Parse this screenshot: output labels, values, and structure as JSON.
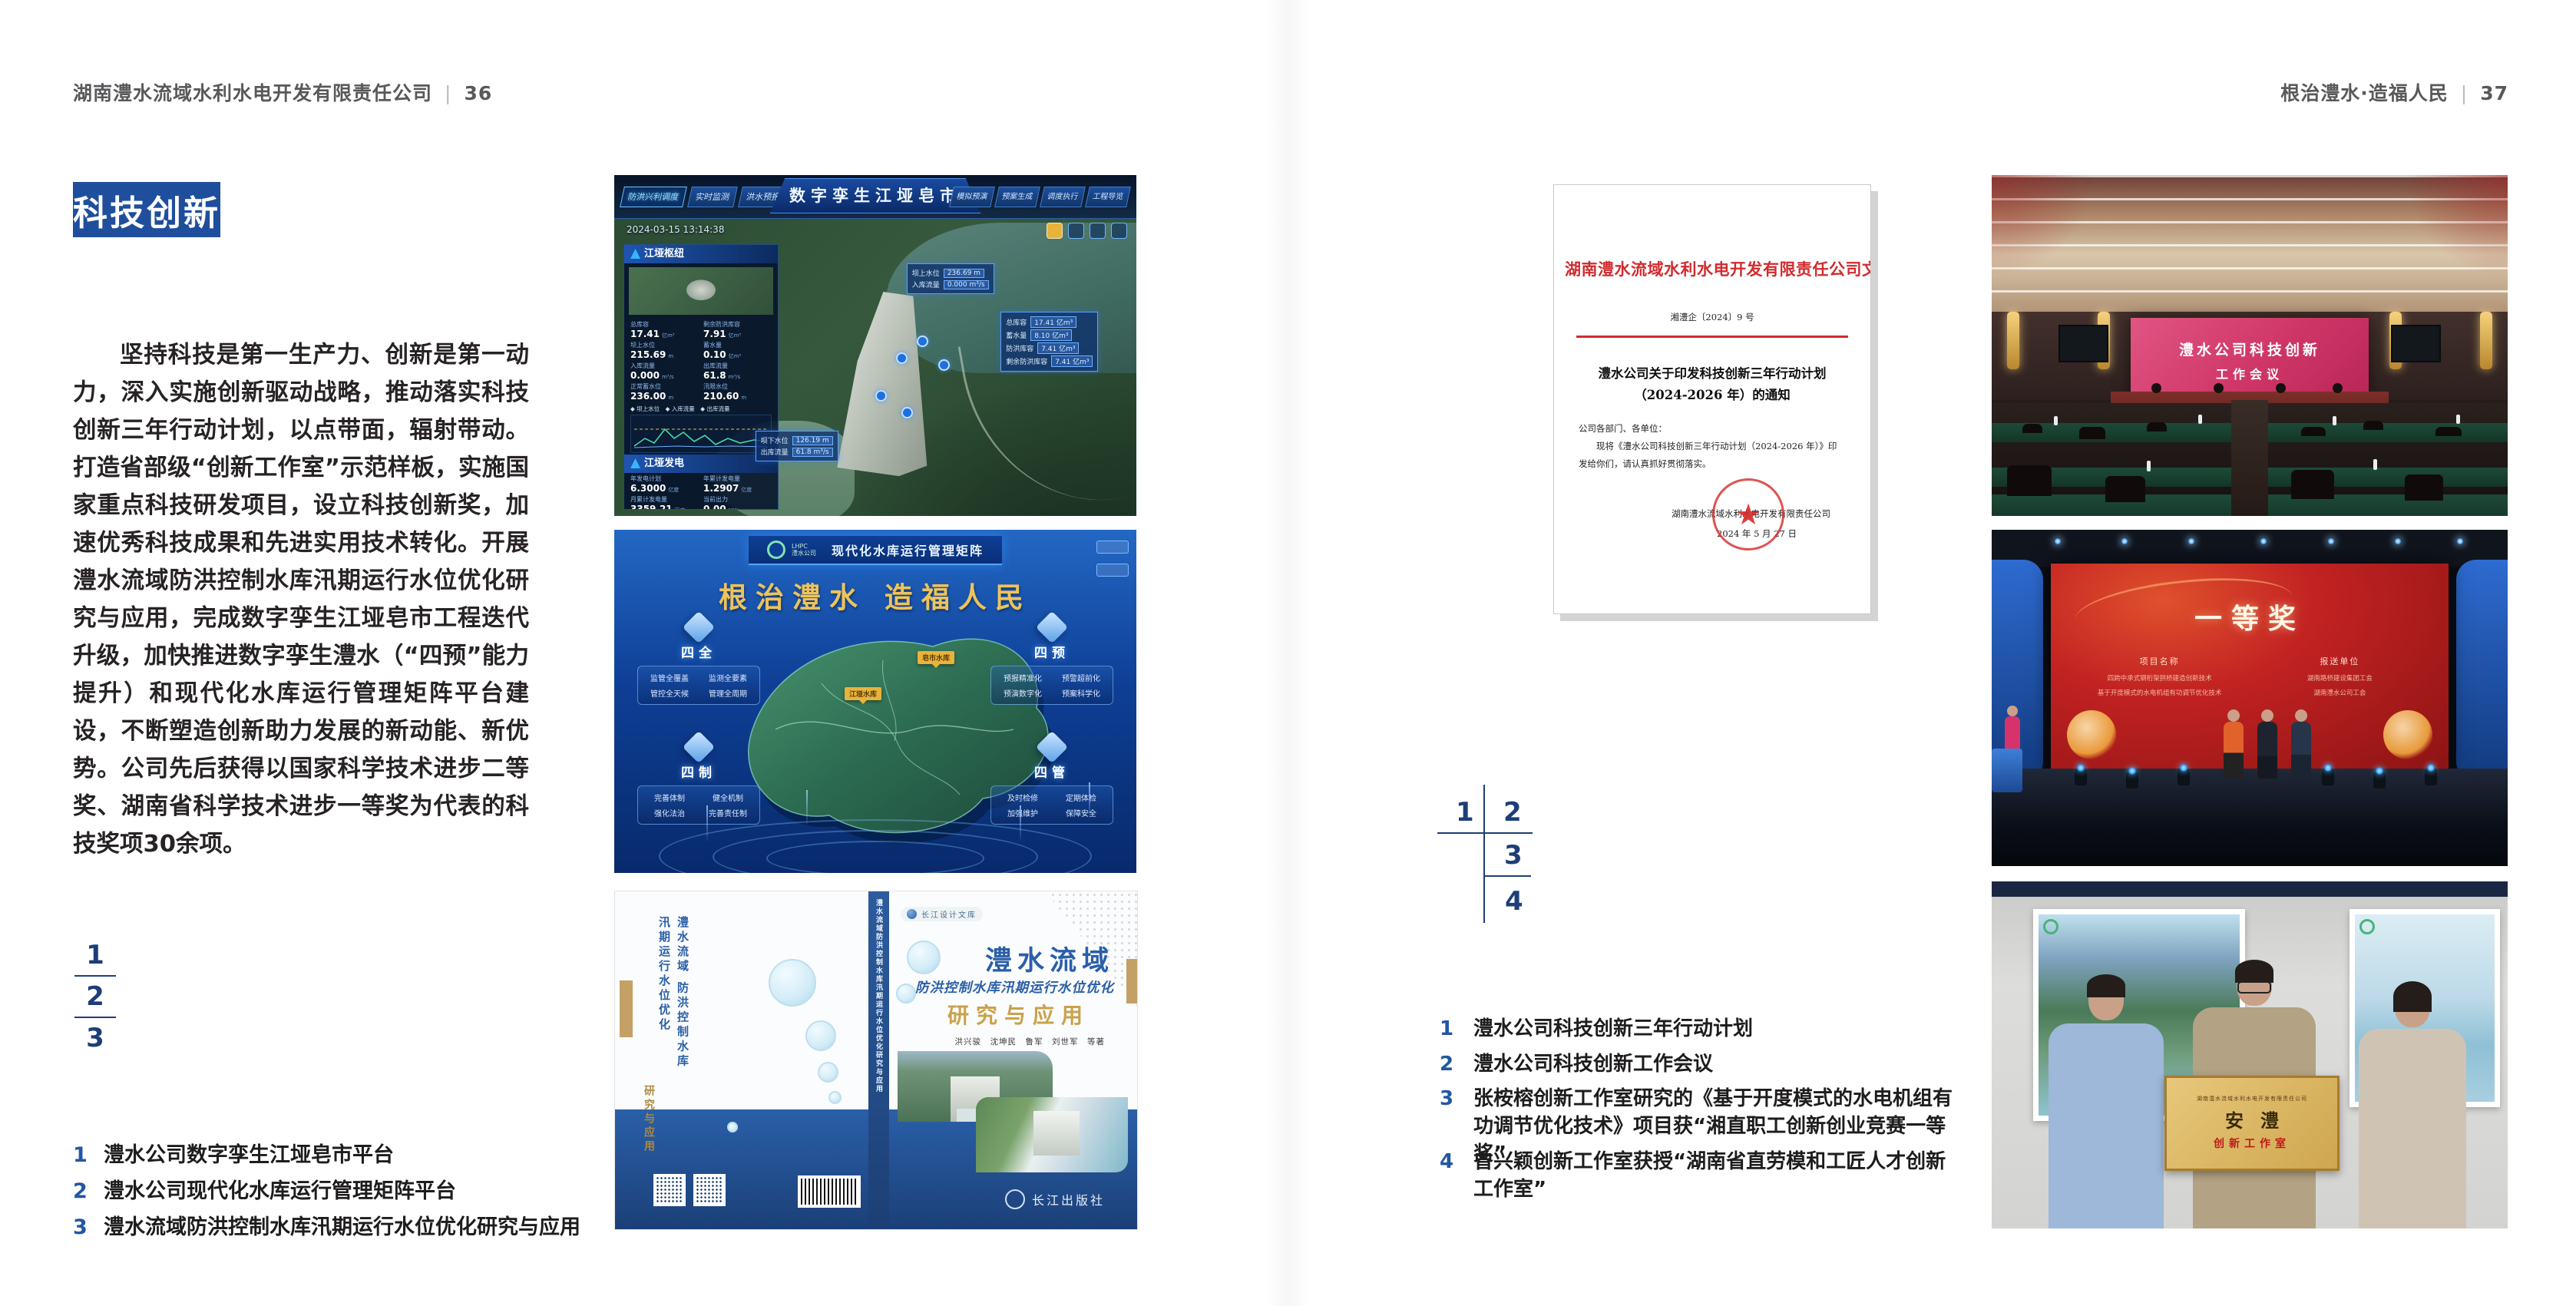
{
  "colors": {
    "accent_blue": "#1f4e9c",
    "key_number_blue": "#1d3e78",
    "caption_number_blue": "#2157a2",
    "document_red": "#d12b2e",
    "meeting_screen_pink": "#cf3668",
    "award_screen_red": "#c22222",
    "plaque_gold": "#d8b264",
    "book_title_blue": "#2a5fa8",
    "book_title_gold": "#c9a24b"
  },
  "left_page": {
    "header": {
      "title": "湖南澧水流域水利水电开发有限责任公司",
      "separator": "|",
      "page_number": "36"
    },
    "badge": "科技创新",
    "paragraph": "坚持科技是第一生产力、创新是第一动力，深入实施创新驱动战略，推动落实科技创新三年行动计划，以点带面，辐射带动。打造省部级“创新工作室”示范样板，实施国家重点科技研发项目，设立科技创新奖，加速优秀科技成果和先进实用技术转化。开展澧水流域防洪控制水库汛期运行水位优化研究与应用，完成数字孪生江垭皂市工程迭代升级，加快推进数字孪生澧水（“四预”能力提升）和现代化水库运行管理矩阵平台建设，不断塑造创新助力发展的新动能、新优势。公司先后获得以国家科学技术进步二等奖、湖南省科学技术进步一等奖为代表的科技奖项30余项。",
    "figure_key": {
      "n1": "1",
      "n2": "2",
      "n3": "3"
    },
    "captions": [
      {
        "num": "1",
        "text": "澧水公司数字孪生江垭皂市平台"
      },
      {
        "num": "2",
        "text": "澧水公司现代化水库运行管理矩阵平台"
      },
      {
        "num": "3",
        "text": "澧水流域防洪控制水库汛期运行水位优化研究与应用"
      }
    ]
  },
  "right_page": {
    "header": {
      "title": "根治澧水·造福人民",
      "separator": "|",
      "page_number": "37"
    },
    "figure_key": {
      "n1": "1",
      "n2": "2",
      "n3": "3",
      "n4": "4"
    },
    "captions": [
      {
        "num": "1",
        "text": "澧水公司科技创新三年行动计划"
      },
      {
        "num": "2",
        "text": "澧水公司科技创新工作会议"
      },
      {
        "num": "3",
        "text": "张桉榕创新工作室研究的《基于开度模式的水电机组有功调节优化技术》项目获“湘直职工创新创业竞赛一等奖”"
      },
      {
        "num": "4",
        "text": "曾兴颖创新工作室获授“湖南省直劳模和工匠人才创新工作室”"
      }
    ]
  },
  "figures": {
    "digital_twin": {
      "title": "数字孪生江垭皂市",
      "timestamp": "2024-03-15 13:14:38",
      "group_label": "防洪兴利调度",
      "tabs_left": [
        "实时监测",
        "洪水预报",
        "防汛预警"
      ],
      "tabs_right": [
        "模拟预演",
        "预案生成",
        "调度执行",
        "工程导览"
      ],
      "panel1_title": "江垭枢纽",
      "panel1_stats": [
        {
          "l": "总库容",
          "v": "17.41",
          "u": "亿m³"
        },
        {
          "l": "剩余防洪库容",
          "v": "7.91",
          "u": "亿m³"
        },
        {
          "l": "坝上水位",
          "v": "215.69",
          "u": "m"
        },
        {
          "l": "蓄水量",
          "v": "0.10",
          "u": "亿m³"
        },
        {
          "l": "入库流量",
          "v": "0.000",
          "u": "m³/s"
        },
        {
          "l": "出库流量",
          "v": "61.8",
          "u": "m³/s"
        },
        {
          "l": "正常蓄水位",
          "v": "236.00",
          "u": "m"
        },
        {
          "l": "汛限水位",
          "v": "210.60",
          "u": "m"
        }
      ],
      "legend": "◆ 坝上水位　◆ 入库流量　◆ 出库流量",
      "panel2_title": "江垭发电",
      "panel2_stats": [
        {
          "l": "年发电计划",
          "v": "6.3000",
          "u": "亿度"
        },
        {
          "l": "年累计发电量",
          "v": "1.2907",
          "u": "亿度"
        },
        {
          "l": "月累计发电量",
          "v": "3359.21",
          "u": "万度"
        },
        {
          "l": "当前出力",
          "v": "0.00",
          "u": "MW"
        }
      ],
      "callout1": [
        {
          "l": "坝上水位",
          "v": "236.69 m"
        },
        {
          "l": "入库流量",
          "v": "0.000 m³/s"
        }
      ],
      "callout2": [
        {
          "l": "总库容",
          "v": "17.41 亿m³"
        },
        {
          "l": "蓄水量",
          "v": "8.10 亿m³"
        },
        {
          "l": "防洪库容",
          "v": "7.41 亿m³"
        },
        {
          "l": "剩余防洪库容",
          "v": "7.41 亿m³"
        }
      ],
      "callout3": [
        {
          "l": "坝下水位",
          "v": "126.19 m"
        },
        {
          "l": "出库流量",
          "v": "61.8 m³/s"
        }
      ]
    },
    "matrix": {
      "logo_line1": "LHPC",
      "logo_line2": "澧水公司",
      "title": "现代化水库运行管理矩阵",
      "slogan": "根治澧水 造福人民",
      "modules": [
        {
          "name": "四全",
          "items": [
            "监管全覆盖",
            "监测全要素",
            "管控全天候",
            "管理全周期"
          ]
        },
        {
          "name": "四预",
          "items": [
            "预报精准化",
            "预警超前化",
            "预演数字化",
            "预案科学化"
          ]
        },
        {
          "name": "四制",
          "items": [
            "完善体制",
            "健全机制",
            "强化法治",
            "完善责任制"
          ]
        },
        {
          "name": "四管",
          "items": [
            "及时检修",
            "定期体检",
            "加强维护",
            "保障安全"
          ]
        }
      ],
      "marker1": "皂市水库",
      "marker2": "江垭水库"
    },
    "book": {
      "series": "长江设计文库",
      "back_title": "澧水流域 防洪控制水库汛期运行水位优化",
      "back_subtitle": "研究与应用",
      "spine": "澧水流域防洪控制水库汛期运行水位优化研究与应用",
      "title1": "澧水流域",
      "title2": "防洪控制水库汛期运行水位优化",
      "title3": "研究与应用",
      "authors": "洪兴骏　沈坤民　鲁军　刘世军　等著",
      "press": "长江出版社"
    },
    "document": {
      "red_title": "湖南澧水流域水利水电开发有限责任公司文件",
      "doc_no": "湘澧企〔2024〕9 号",
      "subject1": "澧水公司关于印发科技创新三年行动计划",
      "subject2": "（2024-2026 年）的通知",
      "salutation": "公司各部门、各单位：",
      "body1": "现将《澧水公司科技创新三年行动计划（2024-2026 年）》印",
      "body2": "发给你们，请认真抓好贯彻落实。",
      "signer": "湖南澧水流域水利水电开发有限责任公司",
      "date": "2024 年 5 月 27 日"
    },
    "meeting": {
      "screen_line1": "澧水公司科技创新",
      "screen_line2": "工作会议"
    },
    "award": {
      "title": "一等奖",
      "col1_header": "项目名称",
      "col1_row1": "四跨中承式钢桁架拱桥建造创新技术",
      "col1_row2": "基于开度模式的水电机组有功调节优化技术",
      "col2_header": "报送单位",
      "col2_row1": "湖南路桥建设集团工会",
      "col2_row2": "湖南澧水公司工会"
    },
    "plaque": {
      "org": "湖南澧水流域水利水电开发有限责任公司",
      "name": "安澧",
      "subtitle": "创新工作室"
    }
  }
}
